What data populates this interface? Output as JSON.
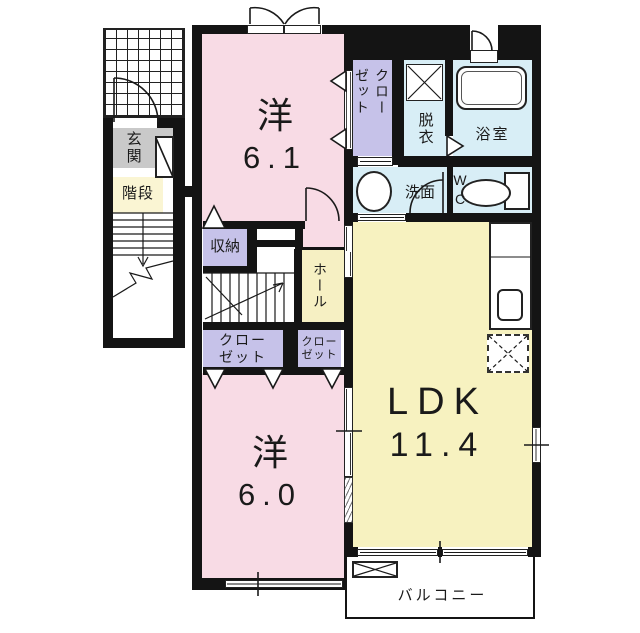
{
  "colors": {
    "wall": "#141414",
    "room_pink": "#f8dbe5",
    "closet_purple": "#c6c2e9",
    "water_blue": "#d8eef6",
    "ldk_yellow": "#f7f2c0",
    "hall_yellow": "#f6f0c3",
    "stairs_yellow": "#faf5d3",
    "entry_gray": "#c9c9c9"
  },
  "rooms": {
    "bedroom1": {
      "name": "洋",
      "area": "6.1"
    },
    "bedroom2": {
      "name": "洋",
      "area": "6.0"
    },
    "ldk": {
      "name": "LDK",
      "area": "11.4"
    },
    "balcony": {
      "label": "バルコニー"
    },
    "entrance": {
      "label": "玄関"
    },
    "staircase": {
      "label": "階段"
    },
    "storage": {
      "label": "収納"
    },
    "hall": {
      "label": "ホール"
    },
    "closet_upper": {
      "line1": "クロー",
      "line2": "ゼット"
    },
    "closet_left": {
      "line1": "クロー",
      "line2": "ゼット"
    },
    "closet_right": {
      "line1": "クロー",
      "line2": "ゼット"
    },
    "dressing": {
      "label": "脱衣"
    },
    "bathroom": {
      "label": "浴室"
    },
    "washroom": {
      "label": "洗面"
    },
    "toilet": {
      "label": "WC"
    }
  }
}
